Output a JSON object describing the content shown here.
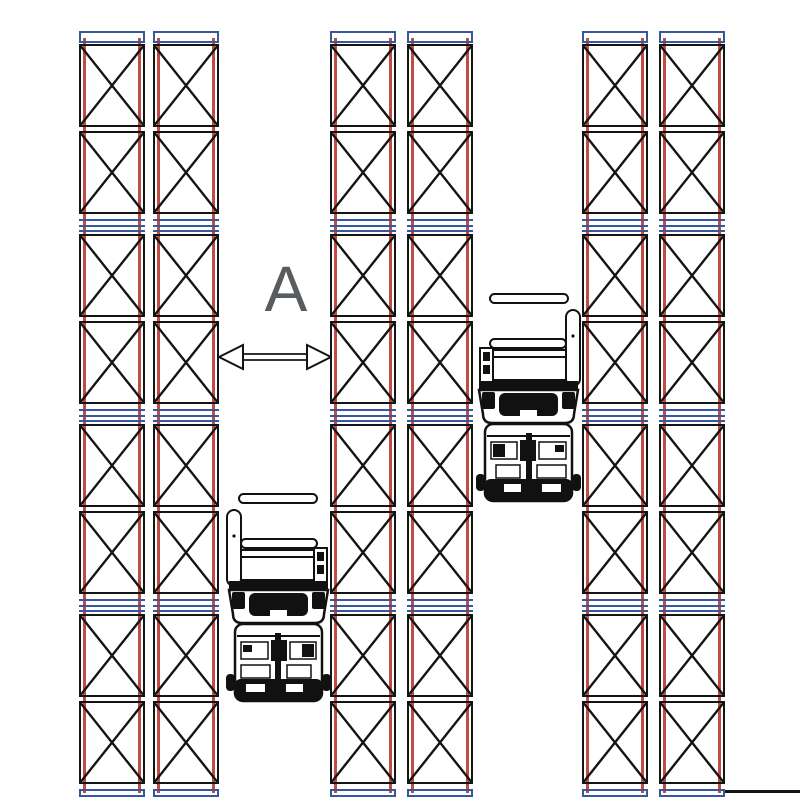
{
  "diagram": {
    "type": "warehouse-narrow-aisle-racking-plan",
    "aisle_label": "A",
    "colors": {
      "rack_upright_red": "#bf4d45",
      "beam_blue": "#35599c",
      "line_black": "#141414",
      "label_gray": "#595c5f",
      "background": "#ffffff"
    },
    "layout_counts": {
      "rack_groups": 3,
      "columns_per_group": 2,
      "bays_per_column": 4,
      "cells_per_bay": 2
    },
    "icons": {
      "cross_brace": "x-brace-icon",
      "dimension_arrow": "double-headed-horizontal-arrow",
      "forklifts": [
        {
          "name": "forklift-icon-1",
          "aisle": 1,
          "facing": "up",
          "mast_arm_side": "left"
        },
        {
          "name": "forklift-icon-2",
          "aisle": 2,
          "facing": "up",
          "mast_arm_side": "right"
        }
      ]
    }
  }
}
